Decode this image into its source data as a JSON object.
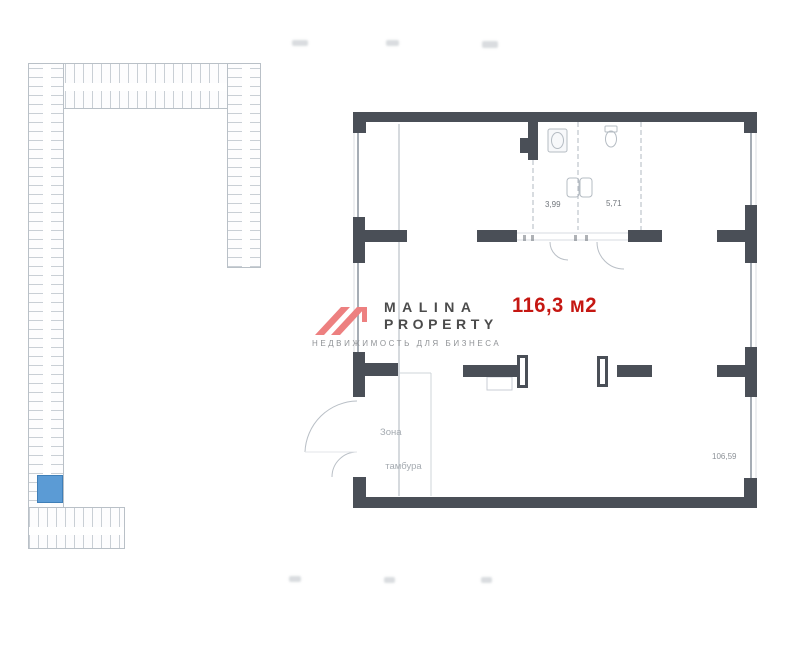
{
  "logo": {
    "brand_line1": "MALINA",
    "brand_line2": "PROPERTY",
    "tagline": "НЕДВИЖИМОСТЬ ДЛЯ БИЗНЕСА",
    "accent_color": "#ed8080",
    "text_color": "#4b4b4b",
    "tagline_color": "#8f9296"
  },
  "unit": {
    "area_label": "116,3 м2",
    "area_color": "#c51712"
  },
  "floorplan": {
    "wall_color": "#4a4f57",
    "labels": {
      "room_small_1": "3,99",
      "room_small_2": "5,71",
      "tambour_line1": "Зона",
      "tambour_line2": "тамбура",
      "main_area": "106,59"
    }
  },
  "minimap": {
    "highlight_color": "#5b9bd5"
  }
}
